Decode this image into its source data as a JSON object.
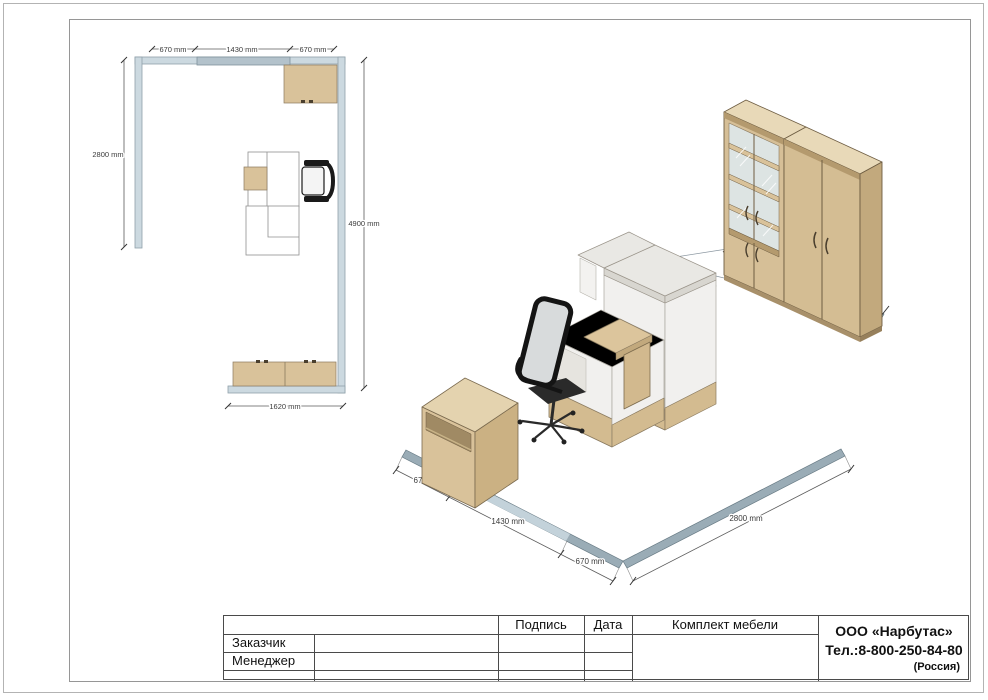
{
  "document": {
    "type": "furniture-layout-drawing",
    "product_title": "Комплект мебели"
  },
  "plan": {
    "dims": {
      "top_left": "670 mm",
      "top_mid": "1430 mm",
      "top_right": "670 mm",
      "left": "2800 mm",
      "right": "4900 mm",
      "bottom": "1620 mm"
    }
  },
  "iso": {
    "dims": {
      "wall_a_seg1": "670 mm",
      "wall_a_seg2": "1430 mm",
      "wall_a_seg3": "670 mm",
      "wall_b": "2800 mm"
    }
  },
  "titleblock": {
    "header_signature": "Подпись",
    "header_date": "Дата",
    "product": "Комплект мебели",
    "row_customer": "Заказчик",
    "row_manager": "Менеджер",
    "company_name": "ООО «Нарбутас»",
    "company_phone": "Тел.:8-800-250-84-80",
    "company_country": "(Россия)"
  },
  "colors": {
    "wood": "#d9c29a",
    "wood_dark": "#c2a97d",
    "wall_plan": "#ccd9e0",
    "wall_iso": "#9aacb6",
    "desk_white": "#f1f0ee",
    "counter_slab": "#e9e8e4",
    "chair_black": "#1a1a1a",
    "table_line": "#4a4a4a"
  }
}
